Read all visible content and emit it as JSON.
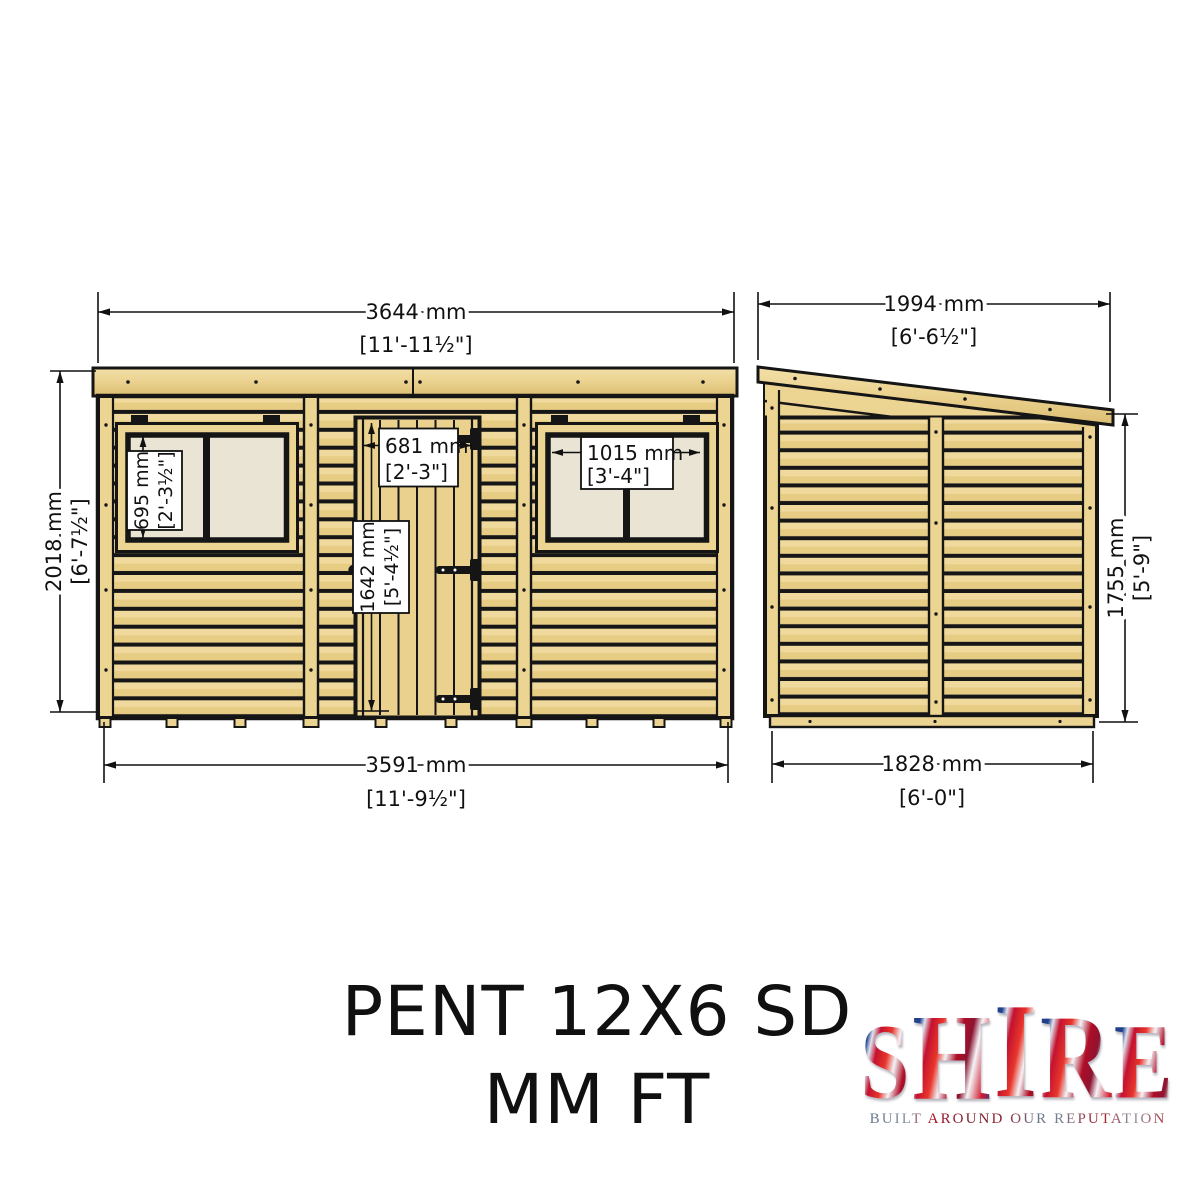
{
  "front_elevation": {
    "width_top": {
      "mm": "3644 mm",
      "ft": "[11'-11½\"]"
    },
    "height_left": {
      "mm": "2018 mm",
      "ft": "[6'-7½\"]"
    },
    "width_bottom": {
      "mm": "3591 mm",
      "ft": "[11'-9½\"]"
    },
    "window_left_height": {
      "mm": "695 mm",
      "ft": "[2'-3½\"]"
    },
    "door_width": {
      "mm": "681 mm",
      "ft": "[2'-3\"]"
    },
    "door_height": {
      "mm": "1642 mm",
      "ft": "[5'-4½\"]"
    },
    "window_right_width": {
      "mm": "1015 mm",
      "ft": "[3'-4\"]"
    }
  },
  "side_elevation": {
    "width_top": {
      "mm": "1994 mm",
      "ft": "[6'-6½\"]"
    },
    "height_right": {
      "mm": "1755 mm",
      "ft": "[5'-9\"]"
    },
    "width_bottom": {
      "mm": "1828 mm",
      "ft": "[6'-0\"]"
    }
  },
  "title": {
    "line1": "PENT 12X6 SD",
    "line2": "MM FT"
  },
  "brand": {
    "name": "SHIRE",
    "tagline": "BUILT AROUND OUR REPUTATION"
  },
  "colors": {
    "wood": "#EAD18E",
    "wood_dark": "#DCBE72",
    "line": "#151515",
    "pane": "#E9E4D3"
  }
}
